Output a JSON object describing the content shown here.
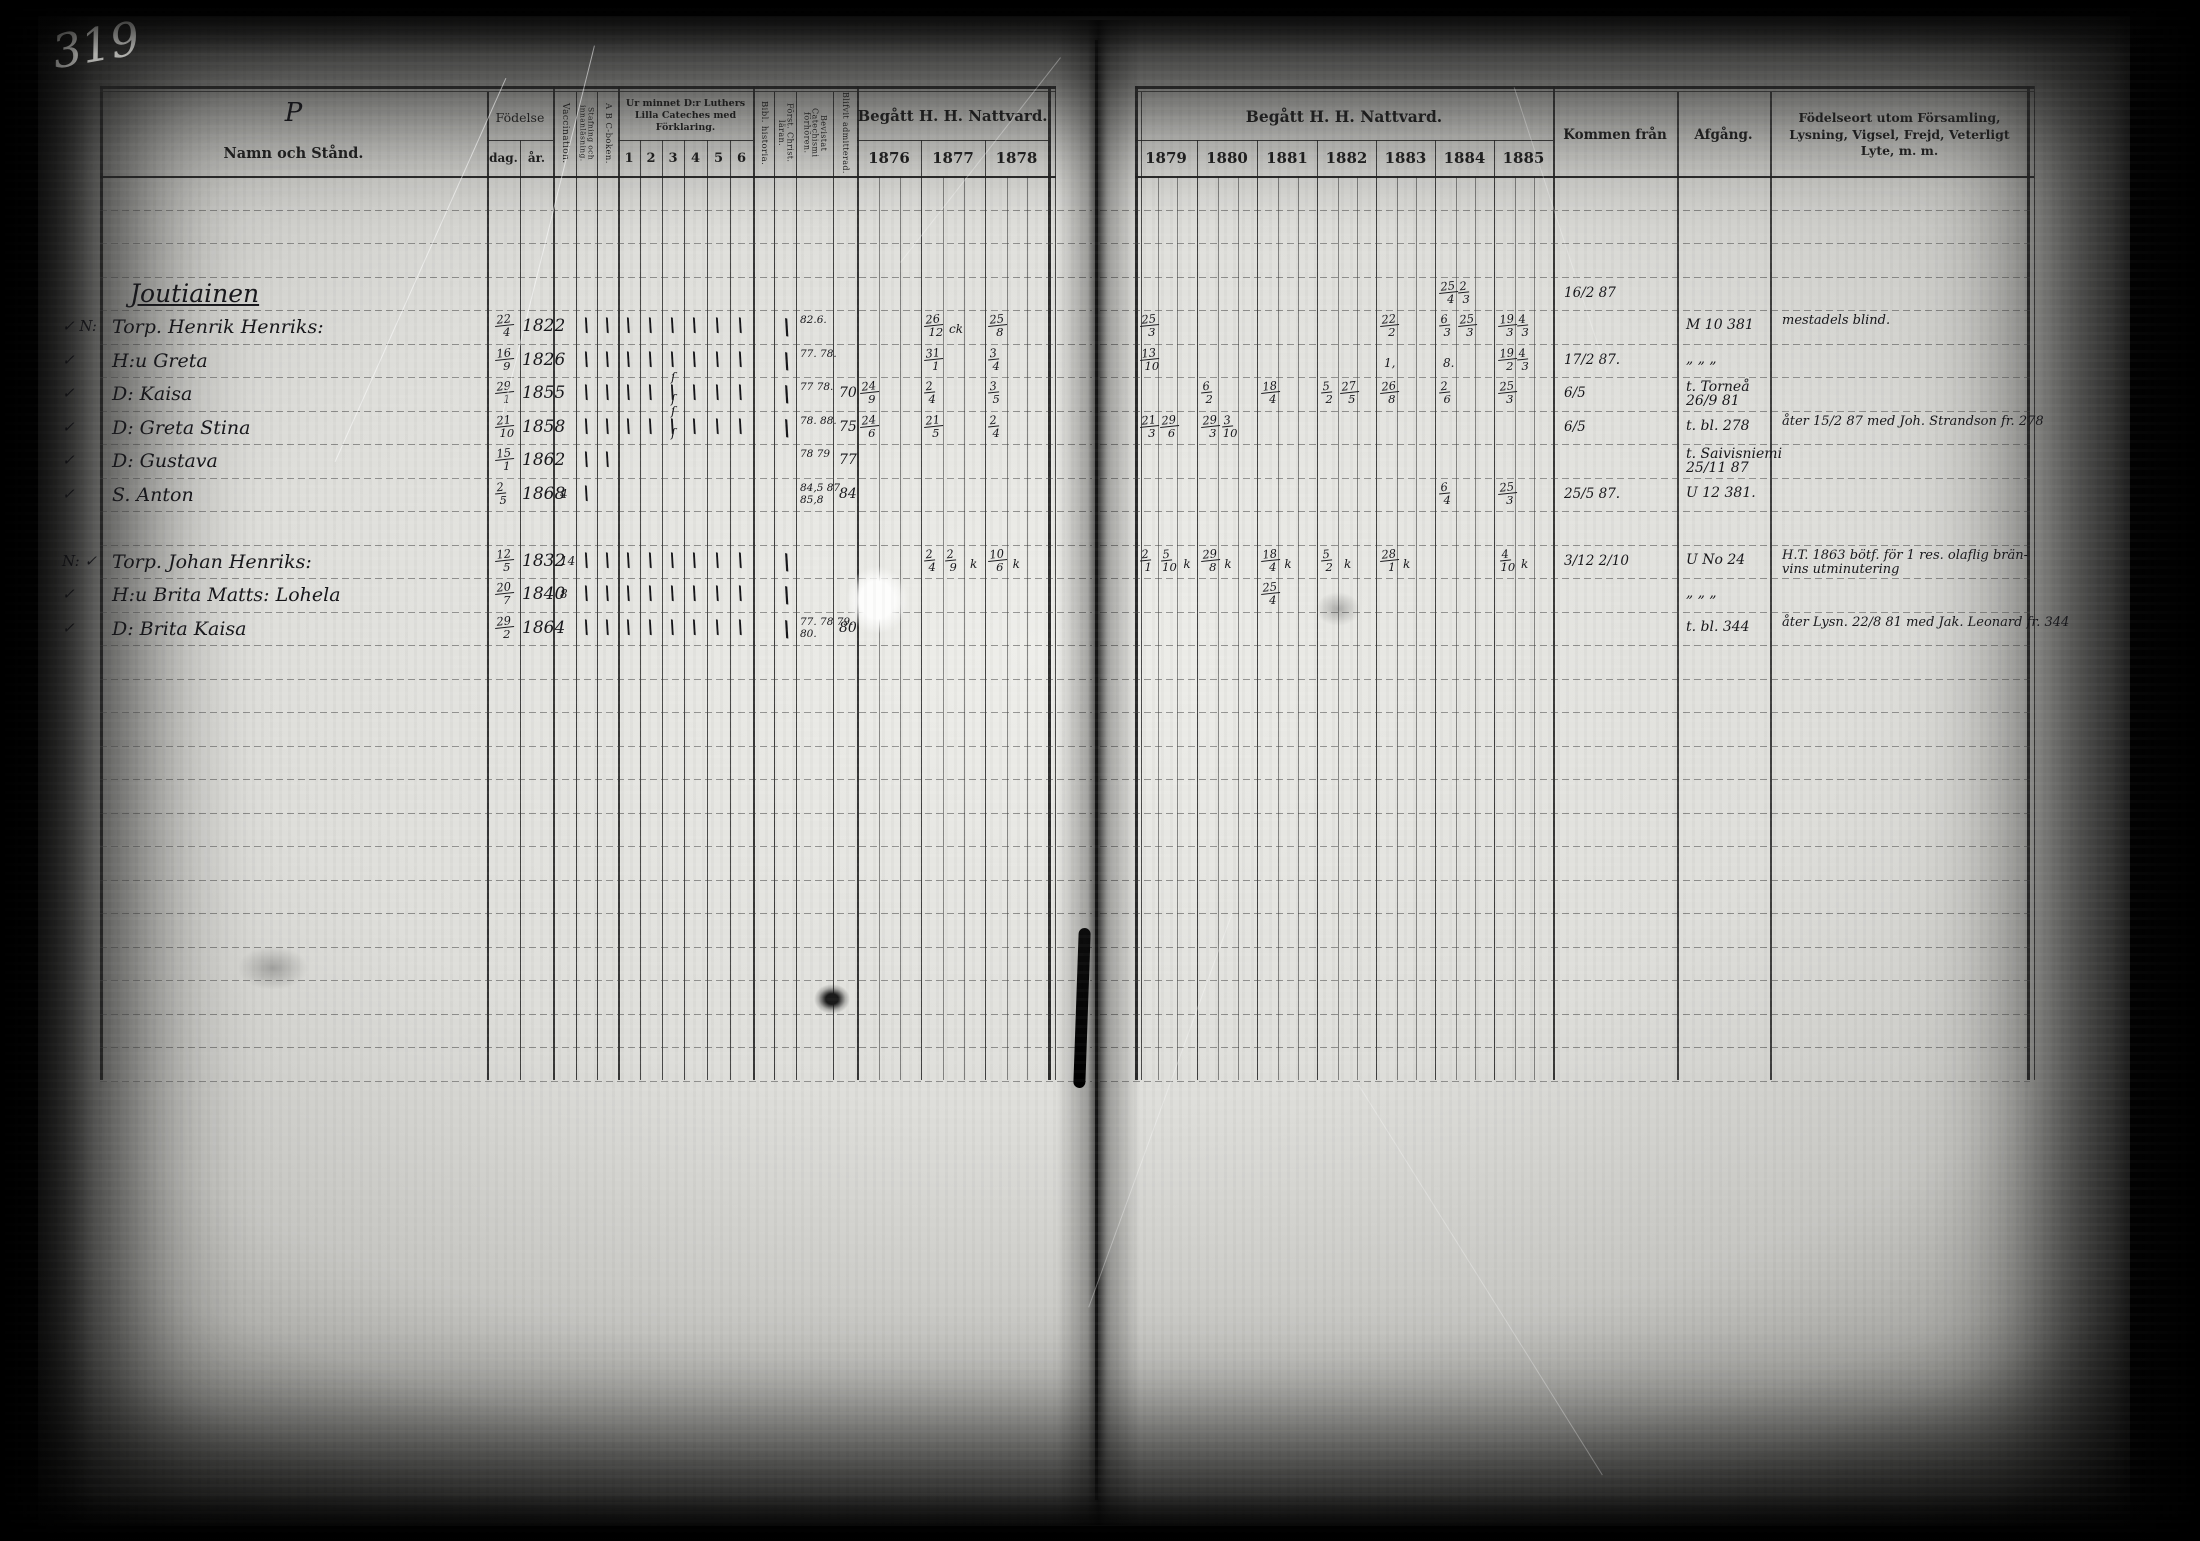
{
  "page": {
    "number": "319"
  },
  "left_table": {
    "headers": {
      "name_flourish": "P",
      "name": "Namn och Stånd.",
      "birth": "Födelse",
      "birth_day": "dag.",
      "birth_year": "år.",
      "vaccination": "Vaccination.",
      "spelling": "Stafning och innanläsning.",
      "abc_book": "A B C-boken.",
      "catechism": "Ur minnet D:r Luthers Lilla Cateches med Förklaring.",
      "catechism_cols": [
        "1",
        "2",
        "3",
        "4",
        "5",
        "6"
      ],
      "bible_history": "Bibl. historia.",
      "christian_doctrine": "Först. Christ. läran.",
      "attended_exams": "Bevistat Catechismi förhören.",
      "admitted": "Blifvit admitterad.",
      "communion": "Begått H. H. Nattvard.",
      "years": [
        "1876",
        "1877",
        "1878"
      ]
    }
  },
  "right_table": {
    "headers": {
      "communion": "Begått H. H. Nattvard.",
      "years": [
        "1879",
        "1880",
        "1881",
        "1882",
        "1883",
        "1884",
        "1885"
      ],
      "come_from": "Kommen från",
      "departure": "Afgång.",
      "notes": "Födelseort utom Församling, Lysning, Vigsel, Frejd, Veterligt Lyte, m. m."
    }
  },
  "rows": [
    {
      "type": "heading",
      "name": "Joutiainen",
      "comm": {
        "1884": [
          "25|4",
          "2|3"
        ]
      },
      "come_from": "16/2 87"
    },
    {
      "margin": "✓ N:",
      "name": "Torp. Henrik Henriks:",
      "day": "22|4",
      "year": "1822",
      "checks": [
        "staf",
        "abc",
        "c1",
        "c2",
        "c3",
        "c4",
        "c5",
        "c6",
        "forst"
      ],
      "attended": [
        "82.6."
      ],
      "comm": {
        "1877": [
          "26|12",
          "ck"
        ],
        "1878": [
          "25|8"
        ],
        "1879": [
          "25|3"
        ],
        "1883": [
          "22|2"
        ],
        "1884": [
          "6|3",
          "25|3"
        ],
        "1885": [
          "19|3",
          "4|3"
        ]
      },
      "departure": [
        "M 10 381"
      ],
      "notes": [
        "mestadels blind."
      ]
    },
    {
      "margin": "✓",
      "name": "H:u Greta",
      "day": "16|9",
      "year": "1826",
      "checks": [
        "staf",
        "abc",
        "c1",
        "c2",
        "c3",
        "c4",
        "c5",
        "c6",
        "forst"
      ],
      "attended": [
        "77. 78."
      ],
      "comm": {
        "1877": [
          "31|1"
        ],
        "1878": [
          "3|4"
        ],
        "1879": [
          "13|10"
        ],
        "1883": [
          "1,"
        ],
        "1884": [
          "8."
        ],
        "1885": [
          "19|2",
          "4|3"
        ]
      },
      "come_from": "17/2 87.",
      "departure": [
        "„  „  „"
      ]
    },
    {
      "margin": "✓",
      "name": "D: Kaisa",
      "day": "29|1",
      "year": "1855",
      "squiggle": true,
      "checks": [
        "staf",
        "abc",
        "c1",
        "c2",
        "c3",
        "c4",
        "c5",
        "c6",
        "forst"
      ],
      "attended": [
        "77 78."
      ],
      "admitted": "70",
      "comm": {
        "1876": [
          "24|9"
        ],
        "1877": [
          "2|4"
        ],
        "1878": [
          "3|5"
        ],
        "1880": [
          "6|2"
        ],
        "1881": [
          "18|4"
        ],
        "1882": [
          "5|2",
          "27|5"
        ],
        "1883": [
          "26|8"
        ],
        "1884": [
          "2|6"
        ],
        "1885": [
          "25|3"
        ]
      },
      "come_from": "6/5",
      "departure": [
        "t. Torneå",
        "26/9 81"
      ]
    },
    {
      "margin": "✓",
      "name": "D: Greta Stina",
      "day": "21|10",
      "year": "1858",
      "squiggle": true,
      "checks": [
        "staf",
        "abc",
        "c1",
        "c2",
        "c3",
        "c4",
        "c5",
        "c6",
        "forst"
      ],
      "attended": [
        "78. 88."
      ],
      "admitted": "75",
      "comm": {
        "1876": [
          "24|6"
        ],
        "1877": [
          "21|5"
        ],
        "1878": [
          "2|4"
        ],
        "1879": [
          "21|3",
          "29|6"
        ],
        "1880": [
          "29|3",
          "3|10"
        ]
      },
      "come_from": "6/5",
      "departure": [
        "t. bl. 278"
      ],
      "notes": [
        "åter 15/2 87 med Joh. Strandson fr. 278"
      ]
    },
    {
      "margin": "✓",
      "name": "D: Gustava",
      "day": "15|1",
      "year": "1862",
      "checks": [
        "staf",
        "abc"
      ],
      "attended": [
        "78 79"
      ],
      "admitted": "77",
      "comm": {},
      "departure": [
        "t. Saivisniemi",
        "25/11 87"
      ]
    },
    {
      "margin": "✓",
      "name": "S. Anton",
      "day": "2|5",
      "year": "1868",
      "vacc": "4",
      "checks": [
        "staf"
      ],
      "attended": [
        "84,5 87.",
        "85,8"
      ],
      "admitted": "84",
      "comm": {
        "1884": [
          "6|4"
        ],
        "1885": [
          "25|3"
        ]
      },
      "come_from": "25/5 87.",
      "departure": [
        "U 12 381."
      ]
    },
    {
      "type": "blank"
    },
    {
      "margin": "N: ✓",
      "name": "Torp. Johan Henriks:",
      "day": "12|5",
      "year": "1832",
      "vacc": "14",
      "checks": [
        "staf",
        "abc",
        "c1",
        "c2",
        "c3",
        "c4",
        "c5",
        "c6",
        "forst"
      ],
      "comm": {
        "1877": [
          "2|4",
          "2|9",
          "k"
        ],
        "1878": [
          "10|6",
          "k"
        ],
        "1879": [
          "2|1",
          "5|10",
          "k"
        ],
        "1880": [
          "29|8",
          "k"
        ],
        "1881": [
          "18|4",
          "k"
        ],
        "1882": [
          "5|2",
          "k"
        ],
        "1883": [
          "28|1",
          "k"
        ],
        "1885": [
          "4|10",
          "k"
        ]
      },
      "come_from": "3/12 2/10",
      "departure": [
        "U No 24"
      ],
      "notes": [
        "H.T. 1863 bötf. för 1 res. olaflig brän-",
        "vins utminutering"
      ]
    },
    {
      "margin": "✓",
      "name": "H:u Brita Matts: Lohela",
      "day": "20|7",
      "year": "1840",
      "vacc": "8",
      "checks": [
        "staf",
        "abc",
        "c1",
        "c2",
        "c3",
        "c4",
        "c5",
        "c6",
        "forst"
      ],
      "comm": {
        "1881": [
          "25|4"
        ]
      },
      "departure": [
        "„  „  „"
      ]
    },
    {
      "margin": "✓",
      "name": "D: Brita Kaisa",
      "day": "29|2",
      "year": "1864",
      "checks": [
        "staf",
        "abc",
        "c1",
        "c2",
        "c3",
        "c4",
        "c5",
        "c6",
        "forst"
      ],
      "attended": [
        "77. 78 79.",
        "80."
      ],
      "admitted": "80",
      "comm": {},
      "departure": [
        "t. bl. 344"
      ],
      "notes": [
        "åter Lysn. 22/8 81 med Jak. Leonard fr. 344"
      ]
    }
  ]
}
